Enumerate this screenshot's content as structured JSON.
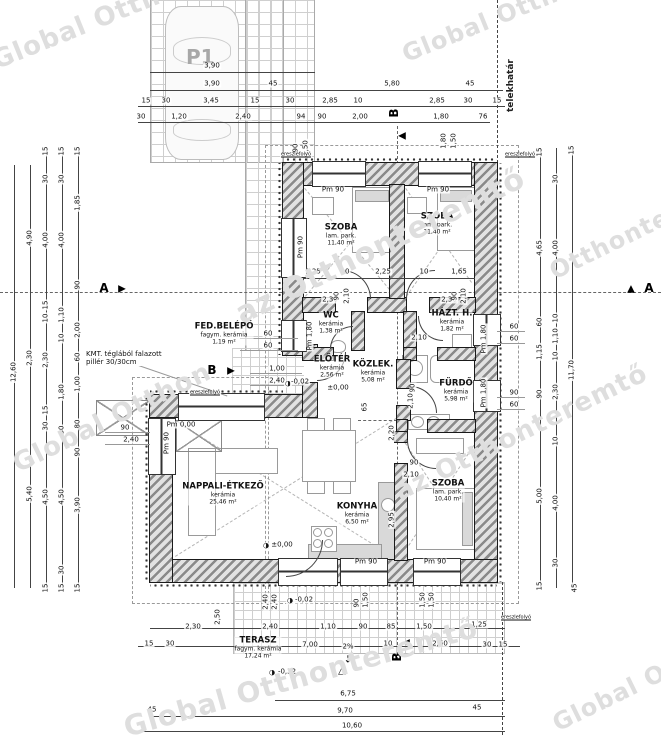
{
  "parking": {
    "label": "P1"
  },
  "boundary": {
    "label": "telekhatár"
  },
  "note": {
    "x": 86,
    "y": 350,
    "lines": [
      "KMT. téglából falazott",
      "pillér 30/30cm"
    ]
  },
  "watermarks": [
    {
      "t": "Global Ottho",
      "x": -12,
      "y": 48,
      "r": -22,
      "s": 26
    },
    {
      "t": "Global Otthonteremtő",
      "x": 398,
      "y": 42,
      "r": -22,
      "s": 24
    },
    {
      "t": "az Otthonteremtő",
      "x": 230,
      "y": 300,
      "r": -26,
      "s": 30
    },
    {
      "t": "Global Otthon",
      "x": 8,
      "y": 452,
      "r": -26,
      "s": 26
    },
    {
      "t": "az Otthonteremtő",
      "x": 390,
      "y": 480,
      "r": -26,
      "s": 26
    },
    {
      "t": "Global Otthonteremtő",
      "x": 120,
      "y": 712,
      "r": -16,
      "s": 28
    },
    {
      "t": "Global Ottho",
      "x": 548,
      "y": 712,
      "r": -26,
      "s": 24
    },
    {
      "t": "Otthonteremtő",
      "x": 545,
      "y": 260,
      "r": -26,
      "s": 24
    }
  ],
  "rooms": [
    {
      "n": "SZOBA",
      "s": "lam. park.",
      "a": "11,40 m²",
      "x": 341,
      "y": 235
    },
    {
      "n": "SZOBA",
      "s": "lam. park.",
      "a": "11,40 m²",
      "x": 437,
      "y": 224
    },
    {
      "n": "WC",
      "s": "kerámia",
      "a": "1,38 m²",
      "x": 331,
      "y": 323
    },
    {
      "n": "HÁZT. H.",
      "s": "kerámia",
      "a": "1,82 m²",
      "x": 452,
      "y": 321
    },
    {
      "n": "ELŐTÉR",
      "s": "kerámia",
      "a": "2,56 m²",
      "x": 332,
      "y": 367
    },
    {
      "n": "KÖZLEK.",
      "s": "kerámia",
      "a": "5,08 m²",
      "x": 373,
      "y": 372
    },
    {
      "n": "FÜRDŐ",
      "s": "kerámia",
      "a": "5,98 m²",
      "x": 456,
      "y": 391
    },
    {
      "n": "NAPPALI-ÉTKEZŐ",
      "s": "kerámia",
      "a": "25,46 m²",
      "x": 223,
      "y": 494
    },
    {
      "n": "KONYHA",
      "s": "kerámia",
      "a": "6,50 m²",
      "x": 357,
      "y": 514
    },
    {
      "n": "SZOBA",
      "s": "lam. park.",
      "a": "10,40 m²",
      "x": 448,
      "y": 491
    },
    {
      "n": "FED.BELÉPŐ",
      "s": "fagym. kerámia",
      "a": "1,19 m²",
      "x": 224,
      "y": 334
    },
    {
      "n": "TERASZ",
      "s": "fagym. kerámia",
      "a": "17,24 m²",
      "x": 258,
      "y": 648
    }
  ],
  "markers": [
    {
      "k": "letter",
      "t": "A",
      "x": 104,
      "y": 288
    },
    {
      "k": "tri",
      "t": "▶",
      "x": 122,
      "y": 289
    },
    {
      "k": "letter",
      "t": "A",
      "x": 649,
      "y": 288
    },
    {
      "k": "tri",
      "t": "▲",
      "x": 631,
      "y": 289
    },
    {
      "k": "letter",
      "t": "B",
      "x": 394,
      "y": 113,
      "r": 90
    },
    {
      "k": "tri",
      "t": "◀",
      "x": 402,
      "y": 136
    },
    {
      "k": "letter",
      "t": "B",
      "x": 212,
      "y": 370
    },
    {
      "k": "tri",
      "t": "▶",
      "x": 231,
      "y": 371
    },
    {
      "k": "letter",
      "t": "B",
      "x": 397,
      "y": 657,
      "r": 90
    },
    {
      "k": "tri",
      "t": "◀",
      "x": 406,
      "y": 643
    },
    {
      "k": "tri",
      "t": "△",
      "x": 342,
      "y": 671
    },
    {
      "k": "tri",
      "t": "↓",
      "x": 348,
      "y": 660
    }
  ],
  "dims": [
    {
      "t": "3,90",
      "x": 212,
      "y": 66
    },
    {
      "t": "3,90",
      "x": 212,
      "y": 84
    },
    {
      "t": "45",
      "x": 273,
      "y": 84
    },
    {
      "t": "5,80",
      "x": 392,
      "y": 84
    },
    {
      "t": "45",
      "x": 470,
      "y": 84
    },
    {
      "t": "15",
      "x": 146,
      "y": 101
    },
    {
      "t": "30",
      "x": 166,
      "y": 101
    },
    {
      "t": "3,45",
      "x": 211,
      "y": 101
    },
    {
      "t": "15",
      "x": 255,
      "y": 101
    },
    {
      "t": "30",
      "x": 290,
      "y": 101
    },
    {
      "t": "2,85",
      "x": 330,
      "y": 101
    },
    {
      "t": "10",
      "x": 358,
      "y": 101
    },
    {
      "t": "2,85",
      "x": 437,
      "y": 101
    },
    {
      "t": "30",
      "x": 468,
      "y": 101
    },
    {
      "t": "15",
      "x": 497,
      "y": 101
    },
    {
      "t": "30",
      "x": 141,
      "y": 117
    },
    {
      "t": "1,20",
      "x": 179,
      "y": 117
    },
    {
      "t": "2,40",
      "x": 243,
      "y": 117
    },
    {
      "t": "94",
      "x": 301,
      "y": 117
    },
    {
      "t": "90",
      "x": 322,
      "y": 117
    },
    {
      "t": "2,00",
      "x": 360,
      "y": 117
    },
    {
      "t": "1,80",
      "x": 441,
      "y": 117
    },
    {
      "t": "76",
      "x": 483,
      "y": 117
    },
    {
      "t": "90",
      "x": 296,
      "y": 148,
      "r": 1
    },
    {
      "t": "1,50",
      "x": 306,
      "y": 148,
      "r": 1
    },
    {
      "t": "1,80",
      "x": 444,
      "y": 141,
      "r": 1
    },
    {
      "t": "1,50",
      "x": 454,
      "y": 141,
      "r": 1
    },
    {
      "t": "ereszlefolyó",
      "x": 296,
      "y": 155,
      "tiny": 1
    },
    {
      "t": "ereszlefolyó",
      "x": 520,
      "y": 155,
      "tiny": 1
    },
    {
      "t": "ereszlefolyó",
      "x": 205,
      "y": 393,
      "tiny": 1
    },
    {
      "t": "ereszlefolyó",
      "x": 516,
      "y": 618,
      "tiny": 1
    },
    {
      "t": "Pm 90",
      "x": 333,
      "y": 190
    },
    {
      "t": "Pm 90",
      "x": 438,
      "y": 190
    },
    {
      "t": "Pm 90",
      "x": 301,
      "y": 247,
      "r": 1
    },
    {
      "t": "1,25",
      "x": 313,
      "y": 272
    },
    {
      "t": "10",
      "x": 345,
      "y": 272
    },
    {
      "t": "2,25",
      "x": 383,
      "y": 272
    },
    {
      "t": "10",
      "x": 424,
      "y": 272
    },
    {
      "t": "1,65",
      "x": 459,
      "y": 272
    },
    {
      "t": "2,30",
      "x": 330,
      "y": 300
    },
    {
      "t": "2,30",
      "x": 449,
      "y": 300
    },
    {
      "t": "90",
      "x": 337,
      "y": 296,
      "r": 1
    },
    {
      "t": "2,10",
      "x": 347,
      "y": 296,
      "r": 1
    },
    {
      "t": "90",
      "x": 455,
      "y": 296,
      "r": 1
    },
    {
      "t": "2,10",
      "x": 464,
      "y": 296,
      "r": 1
    },
    {
      "t": "Pm 1,80",
      "x": 310,
      "y": 336,
      "r": 1
    },
    {
      "t": "Pm 1,80",
      "x": 484,
      "y": 339,
      "r": 1
    },
    {
      "t": "Pm 1,80",
      "x": 484,
      "y": 393,
      "r": 1
    },
    {
      "t": "60",
      "x": 268,
      "y": 334
    },
    {
      "t": "60",
      "x": 268,
      "y": 346
    },
    {
      "t": "1,00",
      "x": 277,
      "y": 369
    },
    {
      "t": "2,40",
      "x": 277,
      "y": 381
    },
    {
      "t": "◑",
      "x": 288,
      "y": 384
    },
    {
      "t": "-0,02",
      "x": 300,
      "y": 382
    },
    {
      "t": "±0,00",
      "x": 338,
      "y": 388
    },
    {
      "t": "2,10",
      "x": 419,
      "y": 338
    },
    {
      "t": "90",
      "x": 413,
      "y": 388,
      "r": 1
    },
    {
      "t": "2,10",
      "x": 411,
      "y": 401,
      "r": 1
    },
    {
      "t": "65",
      "x": 365,
      "y": 407,
      "r": 1
    },
    {
      "t": "60",
      "x": 514,
      "y": 327
    },
    {
      "t": "60",
      "x": 514,
      "y": 339
    },
    {
      "t": "90",
      "x": 514,
      "y": 393
    },
    {
      "t": "60",
      "x": 514,
      "y": 405
    },
    {
      "t": "90",
      "x": 125,
      "y": 428
    },
    {
      "t": "2,40",
      "x": 131,
      "y": 440
    },
    {
      "t": "Pm 0,00",
      "x": 181,
      "y": 425
    },
    {
      "t": "Pm 90",
      "x": 167,
      "y": 443,
      "r": 1
    },
    {
      "t": "90",
      "x": 414,
      "y": 463
    },
    {
      "t": "2,10",
      "x": 411,
      "y": 475
    },
    {
      "t": "2,20",
      "x": 392,
      "y": 433,
      "r": 1
    },
    {
      "t": "2,95",
      "x": 392,
      "y": 520,
      "r": 1
    },
    {
      "t": "◑",
      "x": 266,
      "y": 546
    },
    {
      "t": "±0,00",
      "x": 282,
      "y": 545
    },
    {
      "t": "Pm 90",
      "x": 366,
      "y": 562
    },
    {
      "t": "Pm 90",
      "x": 435,
      "y": 562
    },
    {
      "t": "12,60",
      "x": 14,
      "y": 372,
      "r": 1
    },
    {
      "t": "4,90",
      "x": 30,
      "y": 238,
      "r": 1
    },
    {
      "t": "2,30",
      "x": 30,
      "y": 358,
      "r": 1
    },
    {
      "t": "5,40",
      "x": 30,
      "y": 494,
      "r": 1
    },
    {
      "t": "15",
      "x": 46,
      "y": 151,
      "r": 1
    },
    {
      "t": "30",
      "x": 46,
      "y": 179,
      "r": 1
    },
    {
      "t": "4,00",
      "x": 46,
      "y": 240,
      "r": 1
    },
    {
      "t": "15",
      "x": 46,
      "y": 305,
      "r": 1
    },
    {
      "t": "10",
      "x": 46,
      "y": 318,
      "r": 1
    },
    {
      "t": "2,30",
      "x": 46,
      "y": 360,
      "r": 1
    },
    {
      "t": "15",
      "x": 46,
      "y": 410,
      "r": 1
    },
    {
      "t": "30",
      "x": 46,
      "y": 426,
      "r": 1
    },
    {
      "t": "4,50",
      "x": 46,
      "y": 497,
      "r": 1
    },
    {
      "t": "15",
      "x": 46,
      "y": 588,
      "r": 1
    },
    {
      "t": "15",
      "x": 62,
      "y": 151,
      "r": 1
    },
    {
      "t": "30",
      "x": 62,
      "y": 179,
      "r": 1
    },
    {
      "t": "4,00",
      "x": 62,
      "y": 240,
      "r": 1
    },
    {
      "t": "1,10",
      "x": 62,
      "y": 315,
      "r": 1
    },
    {
      "t": "10",
      "x": 62,
      "y": 338,
      "r": 1
    },
    {
      "t": "1,80",
      "x": 62,
      "y": 392,
      "r": 1
    },
    {
      "t": "30",
      "x": 62,
      "y": 430,
      "r": 1
    },
    {
      "t": "4,50",
      "x": 62,
      "y": 497,
      "r": 1
    },
    {
      "t": "30",
      "x": 62,
      "y": 570,
      "r": 1
    },
    {
      "t": "15",
      "x": 62,
      "y": 588,
      "r": 1
    },
    {
      "t": "15",
      "x": 78,
      "y": 151,
      "r": 1
    },
    {
      "t": "1,85",
      "x": 78,
      "y": 203,
      "r": 1
    },
    {
      "t": "90",
      "x": 78,
      "y": 285,
      "r": 1
    },
    {
      "t": "2,00",
      "x": 78,
      "y": 330,
      "r": 1
    },
    {
      "t": "60",
      "x": 78,
      "y": 357,
      "r": 1
    },
    {
      "t": "1,00",
      "x": 78,
      "y": 384,
      "r": 1
    },
    {
      "t": "80",
      "x": 78,
      "y": 424,
      "r": 1
    },
    {
      "t": "90",
      "x": 78,
      "y": 452,
      "r": 1
    },
    {
      "t": "3,90",
      "x": 78,
      "y": 505,
      "r": 1
    },
    {
      "t": "15",
      "x": 78,
      "y": 588,
      "r": 1
    },
    {
      "t": "15",
      "x": 540,
      "y": 152,
      "r": 1
    },
    {
      "t": "4,65",
      "x": 540,
      "y": 248,
      "r": 1
    },
    {
      "t": "60",
      "x": 540,
      "y": 322,
      "r": 1
    },
    {
      "t": "1,15",
      "x": 540,
      "y": 352,
      "r": 1
    },
    {
      "t": "90",
      "x": 540,
      "y": 394,
      "r": 1
    },
    {
      "t": "5,00",
      "x": 540,
      "y": 496,
      "r": 1
    },
    {
      "t": "15",
      "x": 540,
      "y": 586,
      "r": 1
    },
    {
      "t": "30",
      "x": 556,
      "y": 179,
      "r": 1
    },
    {
      "t": "4,00",
      "x": 556,
      "y": 248,
      "r": 1
    },
    {
      "t": "10",
      "x": 556,
      "y": 318,
      "r": 1
    },
    {
      "t": "1,10",
      "x": 556,
      "y": 336,
      "r": 1
    },
    {
      "t": "10",
      "x": 556,
      "y": 356,
      "r": 1
    },
    {
      "t": "2,30",
      "x": 556,
      "y": 392,
      "r": 1
    },
    {
      "t": "10",
      "x": 556,
      "y": 441,
      "r": 1
    },
    {
      "t": "4,00",
      "x": 556,
      "y": 503,
      "r": 1
    },
    {
      "t": "30",
      "x": 556,
      "y": 563,
      "r": 1
    },
    {
      "t": "15",
      "x": 572,
      "y": 150,
      "r": 1
    },
    {
      "t": "11,70",
      "x": 572,
      "y": 370,
      "r": 1
    },
    {
      "t": "45",
      "x": 575,
      "y": 588,
      "r": 1
    },
    {
      "t": "2,40",
      "x": 266,
      "y": 602,
      "r": 1
    },
    {
      "t": "2,40",
      "x": 275,
      "y": 602,
      "r": 1
    },
    {
      "t": "2,50",
      "x": 218,
      "y": 617,
      "r": 1
    },
    {
      "t": "◑",
      "x": 290,
      "y": 601
    },
    {
      "t": "-0,02",
      "x": 304,
      "y": 600
    },
    {
      "t": "90",
      "x": 357,
      "y": 603,
      "r": 1
    },
    {
      "t": "1,50",
      "x": 366,
      "y": 600,
      "r": 1
    },
    {
      "t": "1,50",
      "x": 423,
      "y": 600,
      "r": 1
    },
    {
      "t": "1,50",
      "x": 432,
      "y": 600,
      "r": 1
    },
    {
      "t": "2,30",
      "x": 193,
      "y": 627
    },
    {
      "t": "2,40",
      "x": 270,
      "y": 627
    },
    {
      "t": "1,10",
      "x": 328,
      "y": 627
    },
    {
      "t": "90",
      "x": 363,
      "y": 627
    },
    {
      "t": "85",
      "x": 391,
      "y": 627
    },
    {
      "t": "1,50",
      "x": 424,
      "y": 627
    },
    {
      "t": "1,25",
      "x": 479,
      "y": 625
    },
    {
      "t": "15",
      "x": 149,
      "y": 644
    },
    {
      "t": "30",
      "x": 170,
      "y": 644
    },
    {
      "t": "7,00",
      "x": 310,
      "y": 645
    },
    {
      "t": "2%",
      "x": 348,
      "y": 647
    },
    {
      "t": "10",
      "x": 388,
      "y": 644
    },
    {
      "t": "2,60",
      "x": 440,
      "y": 644
    },
    {
      "t": "30",
      "x": 487,
      "y": 645
    },
    {
      "t": "15",
      "x": 503,
      "y": 645
    },
    {
      "t": "◑",
      "x": 272,
      "y": 673
    },
    {
      "t": "-0,32",
      "x": 287,
      "y": 672
    },
    {
      "t": "6,75",
      "x": 348,
      "y": 694
    },
    {
      "t": "45",
      "x": 152,
      "y": 710
    },
    {
      "t": "9,70",
      "x": 345,
      "y": 711
    },
    {
      "t": "10,60",
      "x": 352,
      "y": 726
    },
    {
      "t": "45",
      "x": 477,
      "y": 708
    }
  ]
}
